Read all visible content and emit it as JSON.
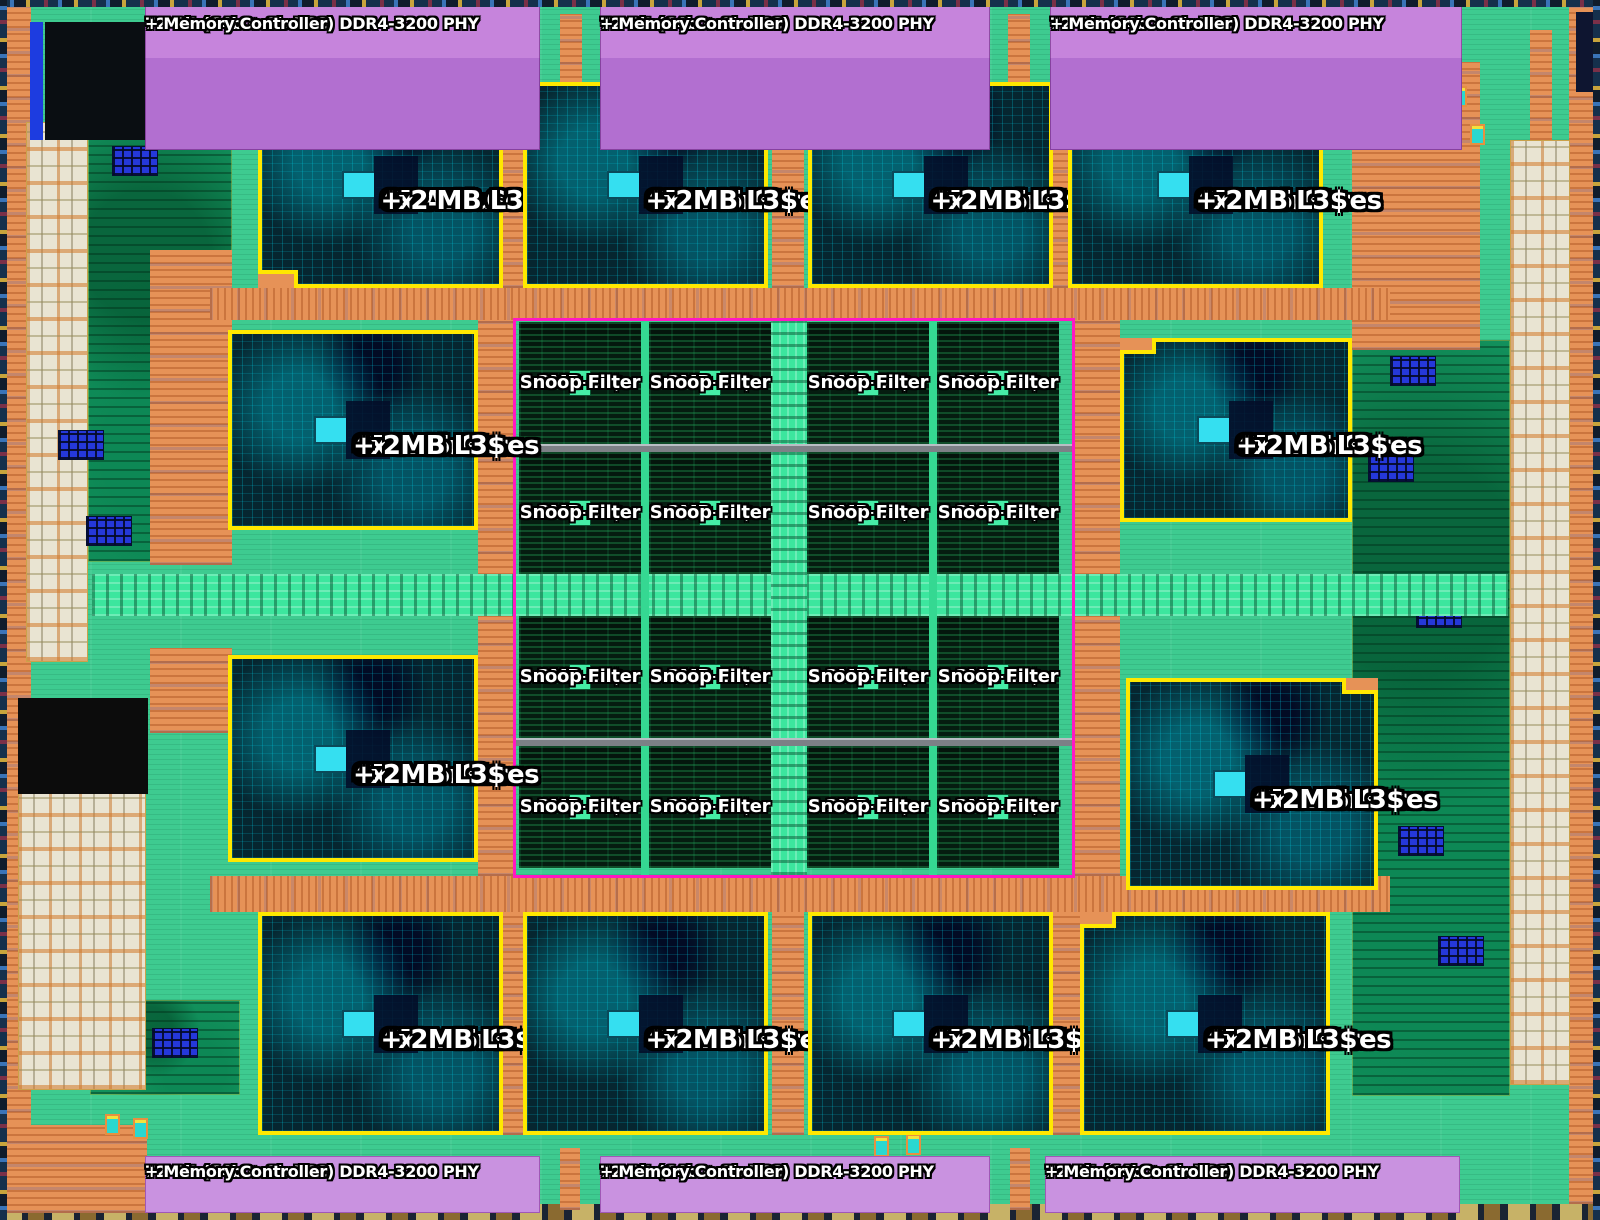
{
  "banners": {
    "top": [
      {
        "line1": "72-Bit (64b + 8b ECC) DDR4-3200 PHY",
        "line2": "+ Memory Controller"
      },
      {
        "line1": "72-Bit (64b + 8b ECC) DDR4-3200 PHY",
        "line2": "+ Memory Controller"
      },
      {
        "line1": "72-Bit (64b + 8b ECC) DDR4-3200 PHY",
        "line2": "+ Memory Controller"
      }
    ],
    "bottom": [
      {
        "line1": "72-Bit (64b + 8b ECC) DDR4-3200 PHY",
        "line2": "+ Memory Controller"
      },
      {
        "line1": "72-Bit (64b + 8b ECC) DDR4-3200 PHY",
        "line2": "+ Memory Controller"
      },
      {
        "line1": "72-Bit (64b + 8b ECC) DDR4-3200 PHY",
        "line2": "+ Memory Controller"
      }
    ]
  },
  "cpu_clusters": [
    {
      "line1": "CPU Cluster",
      "line2": "4x A75 Cores",
      "line3": "+ 2 MB L3$"
    },
    {
      "line1": "CPU Cluster",
      "line2": "4x A75 Cores",
      "line3": "+ 2MB L3$"
    },
    {
      "line1": "CPU Cluster",
      "line2": "4x A75 Cores",
      "line3": "+ 2MB L3$"
    },
    {
      "line1": "CPU Cluster",
      "line2": "4x A75 Cores",
      "line3": "+ 2MB L3$"
    },
    {
      "line1": "CPU Cluster",
      "line2": "4x A75 Cores",
      "line3": "+ 2MB L3$"
    },
    {
      "line1": "CPU Cluster",
      "line2": "4x A75 Cores",
      "line3": "+ 2MB L3$"
    },
    {
      "line1": "CPU Cluster",
      "line2": "4x A75 Cores",
      "line3": "+ 2MB L3$"
    },
    {
      "line1": "CPU Cluster",
      "line2": "4x A75 Cores",
      "line3": "+ 2MB L3$"
    },
    {
      "line1": "CPU Cluster",
      "line2": "4x A75 Cores",
      "line3": "+ 2MB L3$"
    },
    {
      "line1": "CPU Cluster",
      "line2": "4x A75 Cores",
      "line3": "+ 2MB L3$"
    },
    {
      "line1": "CPU Cluster",
      "line2": "4x A75 Cores",
      "line3": "+ 2MB L3$"
    },
    {
      "line1": "CPU Cluster",
      "line2": "4x A75 Cores",
      "line3": "+ 2MB L3$"
    }
  ],
  "l4_tiles": [
    {
      "line1": "2MB L4$",
      "line2": "+",
      "line3": "Snoop Filter"
    },
    {
      "line1": "2MB L4$",
      "line2": "+",
      "line3": "Snoop Filter"
    },
    {
      "line1": "2MB L4$",
      "line2": "+",
      "line3": "Snoop Filter"
    },
    {
      "line1": "2MB L4$",
      "line2": "+",
      "line3": "Snoop Filter"
    },
    {
      "line1": "2MB L4$",
      "line2": "+",
      "line3": "Snoop Filter"
    },
    {
      "line1": "2MB L4$",
      "line2": "+",
      "line3": "Snoop Filter"
    },
    {
      "line1": "2MB L4$",
      "line2": "+",
      "line3": "Snoop Filter"
    },
    {
      "line1": "2MB L4$",
      "line2": "+",
      "line3": "Snoop Filter"
    },
    {
      "line1": "2MB L4$",
      "line2": "+",
      "line3": "Snoop Filter"
    },
    {
      "line1": "2MB L4$",
      "line2": "+",
      "line3": "Snoop Filter"
    },
    {
      "line1": "2MB L4$",
      "line2": "+",
      "line3": "Snoop Filter"
    },
    {
      "line1": "2MB L4$",
      "line2": "+",
      "line3": "Snoop Filter"
    },
    {
      "line1": "2MB L4$",
      "line2": "+",
      "line3": "Snoop Filter"
    },
    {
      "line1": "2MB L4$",
      "line2": "+",
      "line3": "Snoop Filter"
    },
    {
      "line1": "2MB L4$",
      "line2": "+",
      "line3": "Snoop Filter"
    },
    {
      "line1": "2MB L4$",
      "line2": "+",
      "line3": "Snoop Filter"
    }
  ],
  "colors": {
    "die_background_green": "#3ecb90",
    "io_ring_orange": "#e69257",
    "ddr_phy_purple_top": "#b470d4",
    "ddr_phy_purple_bottom": "#c992e0",
    "cpu_cluster_fill": "#062630",
    "cpu_cluster_outline_yellow": "#ffe800",
    "l4_tile_fill": "#051c10",
    "l4_region_outline_magenta": "#ff18c2",
    "mesh_interconnect_green": "#3ce69e",
    "sram_blue": "#2538da",
    "label_text": "#ffffff"
  }
}
